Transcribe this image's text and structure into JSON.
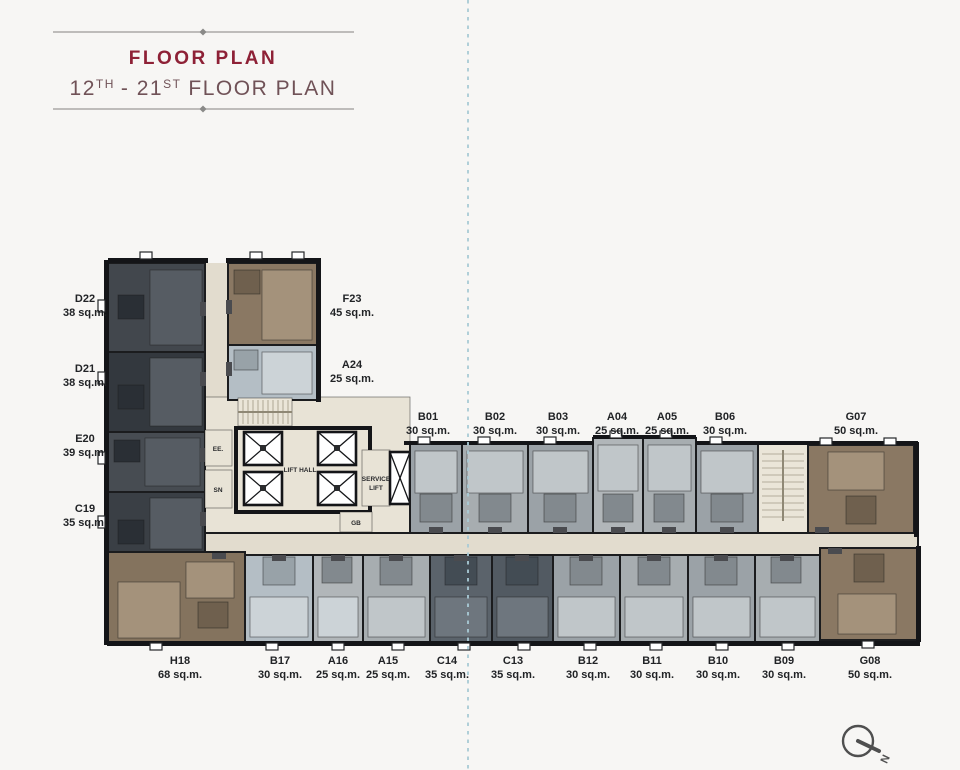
{
  "title": {
    "heading": "FLOOR PLAN",
    "subtitle": {
      "p1": "12",
      "p1_sup": "TH",
      "p2": "- 21",
      "p2_sup": "ST",
      "p3": "FLOOR PLAN"
    }
  },
  "core_labels": {
    "lift_hall": "LIFT HALL",
    "service_line1": "SERVICE",
    "service_line2": "LIFT",
    "ee": "EE.",
    "sn": "SN",
    "gb": "GB"
  },
  "compass": {
    "north": "N"
  },
  "units": {
    "d22": {
      "name": "D22",
      "area": "38 sq.m."
    },
    "d21": {
      "name": "D21",
      "area": "38 sq.m."
    },
    "e20": {
      "name": "E20",
      "area": "39 sq.m."
    },
    "c19": {
      "name": "C19",
      "area": "35 sq.m."
    },
    "f23": {
      "name": "F23",
      "area": "45 sq.m."
    },
    "a24": {
      "name": "A24",
      "area": "25 sq.m."
    },
    "b01": {
      "name": "B01",
      "area": "30 sq.m."
    },
    "b02": {
      "name": "B02",
      "area": "30 sq.m."
    },
    "b03": {
      "name": "B03",
      "area": "30 sq.m."
    },
    "a04": {
      "name": "A04",
      "area": "25 sq.m."
    },
    "a05": {
      "name": "A05",
      "area": "25 sq.m."
    },
    "b06": {
      "name": "B06",
      "area": "30 sq.m."
    },
    "g07": {
      "name": "G07",
      "area": "50 sq.m."
    },
    "h18": {
      "name": "H18",
      "area": "68 sq.m."
    },
    "b17": {
      "name": "B17",
      "area": "30 sq.m."
    },
    "a16": {
      "name": "A16",
      "area": "25 sq.m."
    },
    "a15": {
      "name": "A15",
      "area": "25 sq.m."
    },
    "c14": {
      "name": "C14",
      "area": "35 sq.m."
    },
    "c13": {
      "name": "C13",
      "area": "35 sq.m."
    },
    "b12": {
      "name": "B12",
      "area": "30 sq.m."
    },
    "b11": {
      "name": "B11",
      "area": "30 sq.m."
    },
    "b10": {
      "name": "B10",
      "area": "30 sq.m."
    },
    "b09": {
      "name": "B09",
      "area": "30 sq.m."
    },
    "g08": {
      "name": "G08",
      "area": "50 sq.m."
    }
  },
  "palette": {
    "background": "#f7f6f4",
    "titleRed": "#8e2136",
    "titleSub": "#705257",
    "titleLine": "#9b9a98",
    "divider": "#a9cbd6",
    "corridor": "#e2dcce",
    "coreBeige": "#e8e3d6",
    "stairBeige": "#eae5d8",
    "darkUnit1": "#42474d",
    "darkUnit2": "#33383e",
    "darkUnit3": "#474c52",
    "darkUnit4": "#3a3f45",
    "darkInner": "#565c63",
    "darkBath": "#2a2f35",
    "slateUnit1": "#5b636b",
    "slateUnit2": "#525a62",
    "slateInner": "#6e767e",
    "slateBath": "#434c54",
    "grayUnit1": "#9ba2a7",
    "grayUnit2": "#a7adb0",
    "grayUnit3": "#b1b6b9",
    "grayInner": "#c0c6c9",
    "grayBath": "#82898e",
    "lightUnit": "#b4bec5",
    "lightInner": "#ccd3d7",
    "lightBath": "#98a2a8",
    "brownUnit": "#8a7863",
    "brownDark": "#84735e",
    "brownInner": "#a4927b",
    "brownBath": "#6f604e",
    "door": "#4a4b4f",
    "compass": "#4f4f4f"
  }
}
